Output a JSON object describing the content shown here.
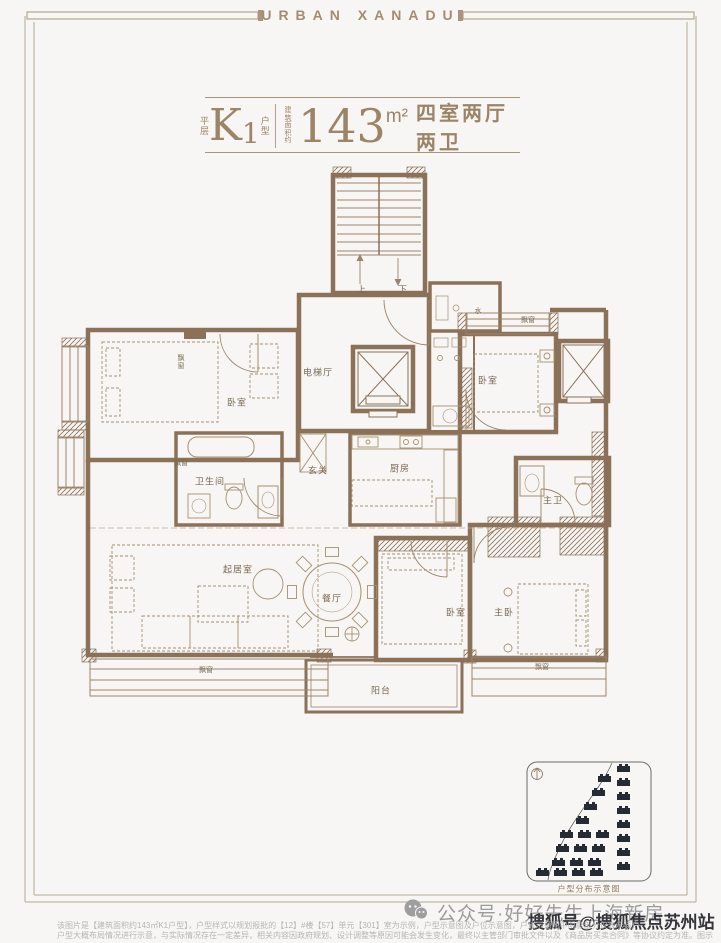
{
  "header": {
    "brand": "URBAN XANADU"
  },
  "title": {
    "floor_label": "平层",
    "unit_main": "K",
    "unit_sub": "1",
    "unit_suffix": "户型",
    "area_prefix": "建筑面积约",
    "area_value": "143",
    "area_unit": "m²",
    "rooms_summary": "四室两厅两卫"
  },
  "plan": {
    "rooms": [
      {
        "id": "bedroom-1",
        "label": "卧室"
      },
      {
        "id": "bay-window-left-upper",
        "label": "飘窗"
      },
      {
        "id": "elevator-hall",
        "label": "电梯厅"
      },
      {
        "id": "water-meter",
        "label": "水"
      },
      {
        "id": "bedroom-2",
        "label": "卧室"
      },
      {
        "id": "bay-window-top-right",
        "label": "飘窗"
      },
      {
        "id": "foyer",
        "label": "玄关"
      },
      {
        "id": "kitchen",
        "label": "厨房"
      },
      {
        "id": "bathroom",
        "label": "卫生间"
      },
      {
        "id": "bay-window-left-lower",
        "label": "飘窗"
      },
      {
        "id": "living-room",
        "label": "起居室"
      },
      {
        "id": "dining-room",
        "label": "餐厅"
      },
      {
        "id": "balcony",
        "label": "阳台"
      },
      {
        "id": "bay-window-bottom-left",
        "label": "飘窗"
      },
      {
        "id": "bedroom-3",
        "label": "卧室"
      },
      {
        "id": "master-bedroom",
        "label": "主卧"
      },
      {
        "id": "master-bathroom",
        "label": "主卫"
      },
      {
        "id": "bay-window-bottom-right",
        "label": "飘窗"
      }
    ],
    "stairs": {
      "up": "上",
      "down": "下"
    }
  },
  "minimap": {
    "caption": "户型分布示意图"
  },
  "footer": {
    "wechat_text": "公众号·好好先生上海新房",
    "watermark": "搜狐号@搜狐焦点苏州站",
    "disclaimer_line_1": "该图片是【建筑面积约143㎡K1户型】，户型样式以规划报批的【12】#楼【57】单元【301】室为示例，户型示意图及户位示意图，户位示意图中阴影部分仅表示该户",
    "disclaimer_line_2": "户型大概布局情况进行示意，与实际情况存在一定差异，相关内容因政府规划、设计调整等原因可能会发生变化，最终以主管部门审批文件以及《商品房买卖合同》等协议约定为准。图示所有示意房屋南向、东"
  },
  "colors": {
    "paper": "#f7f6f4",
    "wall": "#8a7158",
    "accent": "#9c8466",
    "frame": "#b3a491",
    "watermark": "#34343a",
    "map_buildings": "#252a33"
  }
}
